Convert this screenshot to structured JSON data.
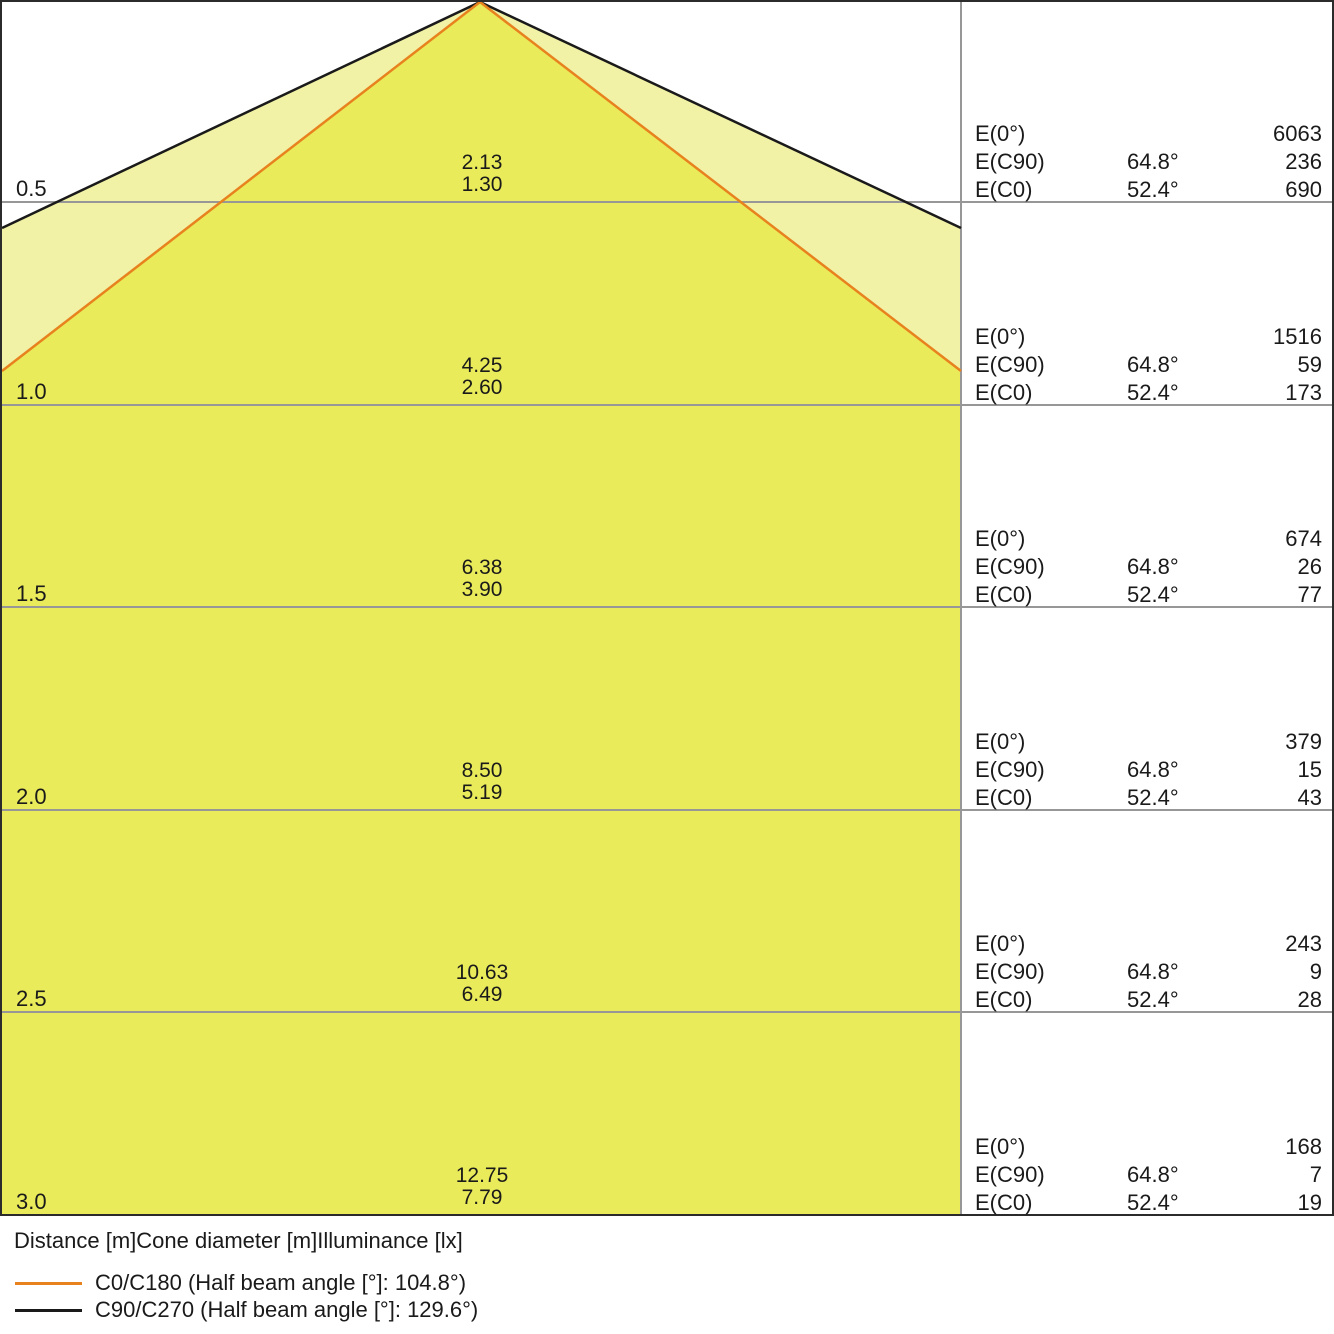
{
  "colors": {
    "cone_outer_fill": "#f1f2a6",
    "cone_inner_fill": "#eaeb5a",
    "c0_line": "#e8821e",
    "c90_line": "#1a1a1a",
    "grid_line": "#979797",
    "text": "#1a1a1a"
  },
  "rows": [
    {
      "distance": "0.5",
      "cone_diameter_c90": "2.13",
      "cone_diameter_c0": "1.30",
      "e0_label": "E(0°)",
      "e0_value": "6063",
      "ec90_label": "E(C90)",
      "ec90_angle": "64.8°",
      "ec90_value": "236",
      "ec0_label": "E(C0)",
      "ec0_angle": "52.4°",
      "ec0_value": "690"
    },
    {
      "distance": "1.0",
      "cone_diameter_c90": "4.25",
      "cone_diameter_c0": "2.60",
      "e0_label": "E(0°)",
      "e0_value": "1516",
      "ec90_label": "E(C90)",
      "ec90_angle": "64.8°",
      "ec90_value": "59",
      "ec0_label": "E(C0)",
      "ec0_angle": "52.4°",
      "ec0_value": "173"
    },
    {
      "distance": "1.5",
      "cone_diameter_c90": "6.38",
      "cone_diameter_c0": "3.90",
      "e0_label": "E(0°)",
      "e0_value": "674",
      "ec90_label": "E(C90)",
      "ec90_angle": "64.8°",
      "ec90_value": "26",
      "ec0_label": "E(C0)",
      "ec0_angle": "52.4°",
      "ec0_value": "77"
    },
    {
      "distance": "2.0",
      "cone_diameter_c90": "8.50",
      "cone_diameter_c0": "5.19",
      "e0_label": "E(0°)",
      "e0_value": "379",
      "ec90_label": "E(C90)",
      "ec90_angle": "64.8°",
      "ec90_value": "15",
      "ec0_label": "E(C0)",
      "ec0_angle": "52.4°",
      "ec0_value": "43"
    },
    {
      "distance": "2.5",
      "cone_diameter_c90": "10.63",
      "cone_diameter_c0": "6.49",
      "e0_label": "E(0°)",
      "e0_value": "243",
      "ec90_label": "E(C90)",
      "ec90_angle": "64.8°",
      "ec90_value": "9",
      "ec0_label": "E(C0)",
      "ec0_angle": "52.4°",
      "ec0_value": "28"
    },
    {
      "distance": "3.0",
      "cone_diameter_c90": "12.75",
      "cone_diameter_c0": "7.79",
      "e0_label": "E(0°)",
      "e0_value": "168",
      "ec90_label": "E(C90)",
      "ec90_angle": "64.8°",
      "ec90_value": "7",
      "ec0_label": "E(C0)",
      "ec0_angle": "52.4°",
      "ec0_value": "19"
    }
  ],
  "footer": {
    "caption": "Distance [m]Cone diameter [m]Illuminance [lx]",
    "legend": [
      {
        "name": "C0/C180",
        "label": "C0/C180 (Half beam angle [°]: 104.8°)",
        "color": "#e8821e"
      },
      {
        "name": "C90/C270",
        "label": "C90/C270 (Half beam angle [°]: 129.6°)",
        "color": "#1a1a1a"
      }
    ]
  },
  "chart_data": {
    "type": "area",
    "title": "Light cone diagram (distance vs. cone diameter and illuminance)",
    "xlabel": "Distance [m]",
    "x": [
      0.5,
      1.0,
      1.5,
      2.0,
      2.5,
      3.0
    ],
    "series": [
      {
        "name": "C0/C180 cone diameter [m]",
        "half_beam_angle_deg": 104.8,
        "color": "#e8821e",
        "values": [
          1.3,
          2.6,
          3.9,
          5.19,
          6.49,
          7.79
        ]
      },
      {
        "name": "C90/C270 cone diameter [m]",
        "half_beam_angle_deg": 129.6,
        "color": "#1a1a1a",
        "values": [
          2.13,
          4.25,
          6.38,
          8.5,
          10.63,
          12.75
        ]
      },
      {
        "name": "E(0°) [lx]",
        "values": [
          6063,
          1516,
          674,
          379,
          243,
          168
        ]
      },
      {
        "name": "E(C90) [lx]",
        "angle": "64.8°",
        "values": [
          236,
          59,
          26,
          15,
          9,
          7
        ]
      },
      {
        "name": "E(C0) [lx]",
        "angle": "52.4°",
        "values": [
          690,
          173,
          77,
          43,
          28,
          19
        ]
      }
    ],
    "legend_position": "bottom-left",
    "grid": "horizontal rows every 0.5 m"
  }
}
